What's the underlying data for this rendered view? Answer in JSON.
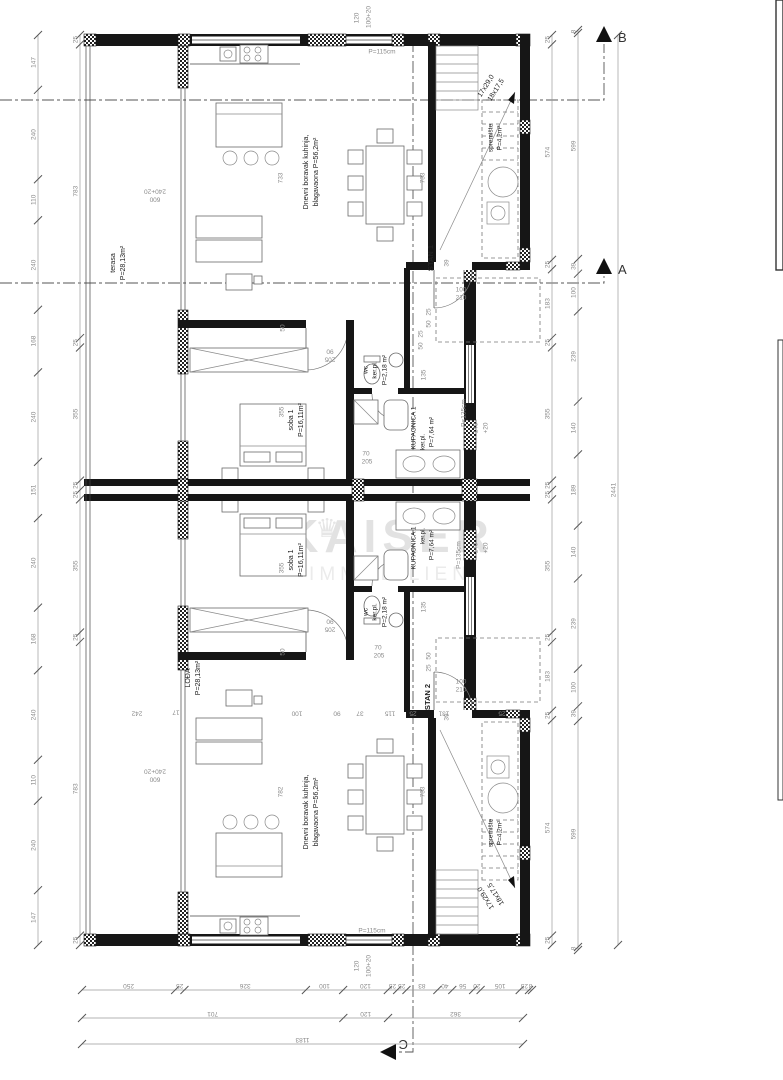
{
  "markers": {
    "a": "A",
    "b": "B",
    "c": "C"
  },
  "watermark": [
    {
      "t": "♛",
      "x": 327,
      "y": 530,
      "r": 0,
      "s": 26,
      "c": "#e6e6e6"
    },
    {
      "t": "KAISER",
      "x": 390,
      "y": 540,
      "r": 0,
      "s": 46,
      "c": "#e2e2e2",
      "b": 1,
      "ls": 6
    },
    {
      "t": "IMMOBILIEN",
      "x": 390,
      "y": 575,
      "r": 0,
      "s": 19,
      "c": "#ebebeb",
      "ls": 5
    }
  ],
  "room_labels": [
    {
      "t": "terasa",
      "x": 113,
      "y": 263,
      "r": -90,
      "s": 7
    },
    {
      "t": "P=28,13m²",
      "x": 123,
      "y": 263,
      "r": -90,
      "s": 7
    },
    {
      "t": "LOĐA",
      "x": 188,
      "y": 678,
      "r": -90,
      "s": 7
    },
    {
      "t": "P=28,13m²",
      "x": 198,
      "y": 678,
      "r": -90,
      "s": 7
    },
    {
      "t": "Dnevni boravak kuhinja,",
      "x": 306,
      "y": 172,
      "r": -90,
      "s": 7
    },
    {
      "t": "blagavaona P=56,2m²",
      "x": 316,
      "y": 172,
      "r": -90,
      "s": 7
    },
    {
      "t": "Dnevni boravak kuhinja,",
      "x": 306,
      "y": 812,
      "r": -90,
      "s": 7
    },
    {
      "t": "blagavaona P=56,2m²",
      "x": 316,
      "y": 812,
      "r": -90,
      "s": 7
    },
    {
      "t": "soba 1",
      "x": 291,
      "y": 420,
      "r": -90,
      "s": 7
    },
    {
      "t": "P=16,11m²",
      "x": 301,
      "y": 420,
      "r": -90,
      "s": 7
    },
    {
      "t": "soba 1",
      "x": 291,
      "y": 560,
      "r": -90,
      "s": 7
    },
    {
      "t": "P=16,11m²",
      "x": 301,
      "y": 560,
      "r": -90,
      "s": 7
    },
    {
      "t": "wc",
      "x": 366,
      "y": 370,
      "r": -90,
      "s": 6.5
    },
    {
      "t": "ker.pl.",
      "x": 375,
      "y": 370,
      "r": -90,
      "s": 6.5
    },
    {
      "t": "P=2,18 m²",
      "x": 385,
      "y": 370,
      "r": -90,
      "s": 6.5
    },
    {
      "t": "wc",
      "x": 366,
      "y": 612,
      "r": -90,
      "s": 6.5
    },
    {
      "t": "ker.pl.",
      "x": 375,
      "y": 612,
      "r": -90,
      "s": 6.5
    },
    {
      "t": "P=2,18 m²",
      "x": 385,
      "y": 612,
      "r": -90,
      "s": 6.5
    },
    {
      "t": "KUPAONICA 1",
      "x": 414,
      "y": 428,
      "r": -90,
      "s": 6.5
    },
    {
      "t": "ker.pl.",
      "x": 423,
      "y": 442,
      "r": -90,
      "s": 6
    },
    {
      "t": "P=7,64 m²",
      "x": 432,
      "y": 432,
      "r": -90,
      "s": 6.5
    },
    {
      "t": "KUPAONICA 1",
      "x": 414,
      "y": 548,
      "r": -90,
      "s": 6.5
    },
    {
      "t": "ker.pl.",
      "x": 423,
      "y": 536,
      "r": -90,
      "s": 6
    },
    {
      "t": "P=7,64 m²",
      "x": 432,
      "y": 545,
      "r": -90,
      "s": 6.5
    },
    {
      "t": "STAN 1",
      "x": 431,
      "y": 258,
      "r": -90,
      "s": 7.5,
      "b": 1
    },
    {
      "t": "STAN 2",
      "x": 428,
      "y": 697,
      "r": -90,
      "s": 7.5,
      "b": 1
    },
    {
      "t": "spremište",
      "x": 491,
      "y": 138,
      "r": -90,
      "s": 6.5
    },
    {
      "t": "P=4,2m²",
      "x": 500,
      "y": 138,
      "r": -90,
      "s": 6.5
    },
    {
      "t": "spremište",
      "x": 491,
      "y": 833,
      "r": -90,
      "s": 6.5
    },
    {
      "t": "P=4,2m²",
      "x": 500,
      "y": 833,
      "r": -90,
      "s": 6.5
    },
    {
      "t": "17x29,0",
      "x": 486,
      "y": 86,
      "r": -58,
      "s": 7
    },
    {
      "t": "18x17,5",
      "x": 496,
      "y": 90,
      "r": -58,
      "s": 7
    },
    {
      "t": "17x29,0",
      "x": 486,
      "y": 898,
      "r": -122,
      "s": 7
    },
    {
      "t": "18x17,5",
      "x": 496,
      "y": 894,
      "r": -122,
      "s": 7
    }
  ],
  "dim_labels": [
    {
      "t": "120",
      "x": 357,
      "y": 18,
      "r": -90
    },
    {
      "t": "100+20",
      "x": 369,
      "y": 17,
      "r": -90
    },
    {
      "t": "P=115cm",
      "x": 382,
      "y": 52,
      "r": 0
    },
    {
      "t": "120",
      "x": 357,
      "y": 966,
      "r": -90
    },
    {
      "t": "100+20",
      "x": 369,
      "y": 966,
      "r": -90
    },
    {
      "t": "P=115cm",
      "x": 372,
      "y": 931,
      "r": 0
    },
    {
      "t": "240+20",
      "x": 155,
      "y": 191,
      "r": 180
    },
    {
      "t": "600",
      "x": 155,
      "y": 199,
      "r": 180
    },
    {
      "t": "240+20",
      "x": 155,
      "y": 771,
      "r": 180
    },
    {
      "t": "600",
      "x": 155,
      "y": 779,
      "r": 180
    },
    {
      "t": "100",
      "x": 461,
      "y": 290,
      "r": 0
    },
    {
      "t": "210",
      "x": 461,
      "y": 298,
      "r": 0
    },
    {
      "t": "100",
      "x": 461,
      "y": 682,
      "r": 0
    },
    {
      "t": "210",
      "x": 461,
      "y": 690,
      "r": 0
    },
    {
      "t": "90",
      "x": 330,
      "y": 351,
      "r": 180
    },
    {
      "t": "205",
      "x": 330,
      "y": 359,
      "r": 180
    },
    {
      "t": "90",
      "x": 330,
      "y": 621,
      "r": 180
    },
    {
      "t": "205",
      "x": 330,
      "y": 629,
      "r": 180
    },
    {
      "t": "70",
      "x": 366,
      "y": 454,
      "r": 0
    },
    {
      "t": "205",
      "x": 367,
      "y": 462,
      "r": 0
    },
    {
      "t": "70",
      "x": 378,
      "y": 648,
      "r": 0
    },
    {
      "t": "205",
      "x": 379,
      "y": 656,
      "r": 0
    },
    {
      "t": "39",
      "x": 447,
      "y": 263,
      "r": -90
    },
    {
      "t": "39",
      "x": 447,
      "y": 717,
      "r": -90
    },
    {
      "t": "25",
      "x": 429,
      "y": 312,
      "r": -90
    },
    {
      "t": "50",
      "x": 429,
      "y": 324,
      "r": -90
    },
    {
      "t": "25",
      "x": 429,
      "y": 668,
      "r": -90
    },
    {
      "t": "50",
      "x": 429,
      "y": 656,
      "r": -90
    },
    {
      "t": "25",
      "x": 421,
      "y": 334,
      "r": -90
    },
    {
      "t": "50",
      "x": 421,
      "y": 346,
      "r": -90
    },
    {
      "t": "135",
      "x": 424,
      "y": 375,
      "r": -90
    },
    {
      "t": "135",
      "x": 424,
      "y": 607,
      "r": -90
    },
    {
      "t": "P=135cm",
      "x": 464,
      "y": 413,
      "r": -90
    },
    {
      "t": "P=135cm",
      "x": 459,
      "y": 555,
      "r": -90
    },
    {
      "t": "140",
      "x": 476,
      "y": 428,
      "r": -90
    },
    {
      "t": "+20",
      "x": 486,
      "y": 428,
      "r": -90
    },
    {
      "t": "140",
      "x": 476,
      "y": 548,
      "r": -90
    },
    {
      "t": "+20",
      "x": 486,
      "y": 548,
      "r": -90
    },
    {
      "t": "50",
      "x": 283,
      "y": 328,
      "r": -90
    },
    {
      "t": "355",
      "x": 282,
      "y": 412,
      "r": -90
    },
    {
      "t": "50",
      "x": 283,
      "y": 652,
      "r": -90
    },
    {
      "t": "355",
      "x": 282,
      "y": 568,
      "r": -90
    },
    {
      "t": "733",
      "x": 281,
      "y": 178,
      "r": -90
    },
    {
      "t": "733",
      "x": 423,
      "y": 178,
      "r": -90
    },
    {
      "t": "782",
      "x": 281,
      "y": 792,
      "r": -90
    },
    {
      "t": "733",
      "x": 423,
      "y": 792,
      "r": -90
    },
    {
      "t": "242",
      "x": 137,
      "y": 713,
      "r": 180
    },
    {
      "t": "17",
      "x": 176,
      "y": 712,
      "r": 180
    },
    {
      "t": "100",
      "x": 297,
      "y": 713,
      "r": 180
    },
    {
      "t": "90",
      "x": 337,
      "y": 713,
      "r": 180
    },
    {
      "t": "37",
      "x": 360,
      "y": 713,
      "r": 180
    },
    {
      "t": "115",
      "x": 390,
      "y": 713,
      "r": 180
    },
    {
      "t": "25",
      "x": 413,
      "y": 713,
      "r": 180
    },
    {
      "t": "131",
      "x": 444,
      "y": 713,
      "r": 180
    },
    {
      "t": "25",
      "x": 502,
      "y": 713,
      "r": 180
    }
  ],
  "chains": {
    "left_outer": {
      "dir": "v",
      "x": 38,
      "a1": 35,
      "a2": 945,
      "values": [
        147,
        240,
        110,
        240,
        168,
        240,
        151,
        240,
        168,
        240,
        110,
        240,
        147
      ]
    },
    "left_inner": {
      "dir": "v",
      "x": 80,
      "a1": 35,
      "a2": 945,
      "values": [
        25,
        783,
        25,
        355,
        25,
        25,
        355,
        25,
        783,
        25
      ]
    },
    "right_1": {
      "dir": "v",
      "x": 552,
      "a1": 35,
      "a2": 945,
      "values": [
        25,
        574,
        25,
        183,
        25,
        355,
        25,
        25,
        355,
        25,
        183,
        25,
        574,
        25
      ]
    },
    "right_2": {
      "dir": "v",
      "x": 578,
      "a1": 30,
      "a2": 950,
      "values": [
        8,
        599,
        39,
        100,
        239,
        140,
        189,
        140,
        239,
        100,
        39,
        599,
        8
      ]
    },
    "right_total": {
      "dir": "v",
      "x": 618,
      "a1": 35,
      "a2": 945,
      "values": [
        2441
      ]
    },
    "bottom_1": {
      "dir": "h",
      "y": 990,
      "a1": 82,
      "a2": 532,
      "values": [
        250,
        25,
        326,
        100,
        120,
        25,
        25,
        83,
        40,
        56,
        20,
        105,
        25,
        8
      ]
    },
    "bottom_2": {
      "dir": "h",
      "y": 1018,
      "a1": 82,
      "a2": 523,
      "values": [
        701,
        120,
        362
      ]
    },
    "bottom_3": {
      "dir": "h",
      "y": 1044,
      "a1": 82,
      "a2": 523,
      "values": [
        1183
      ]
    }
  }
}
